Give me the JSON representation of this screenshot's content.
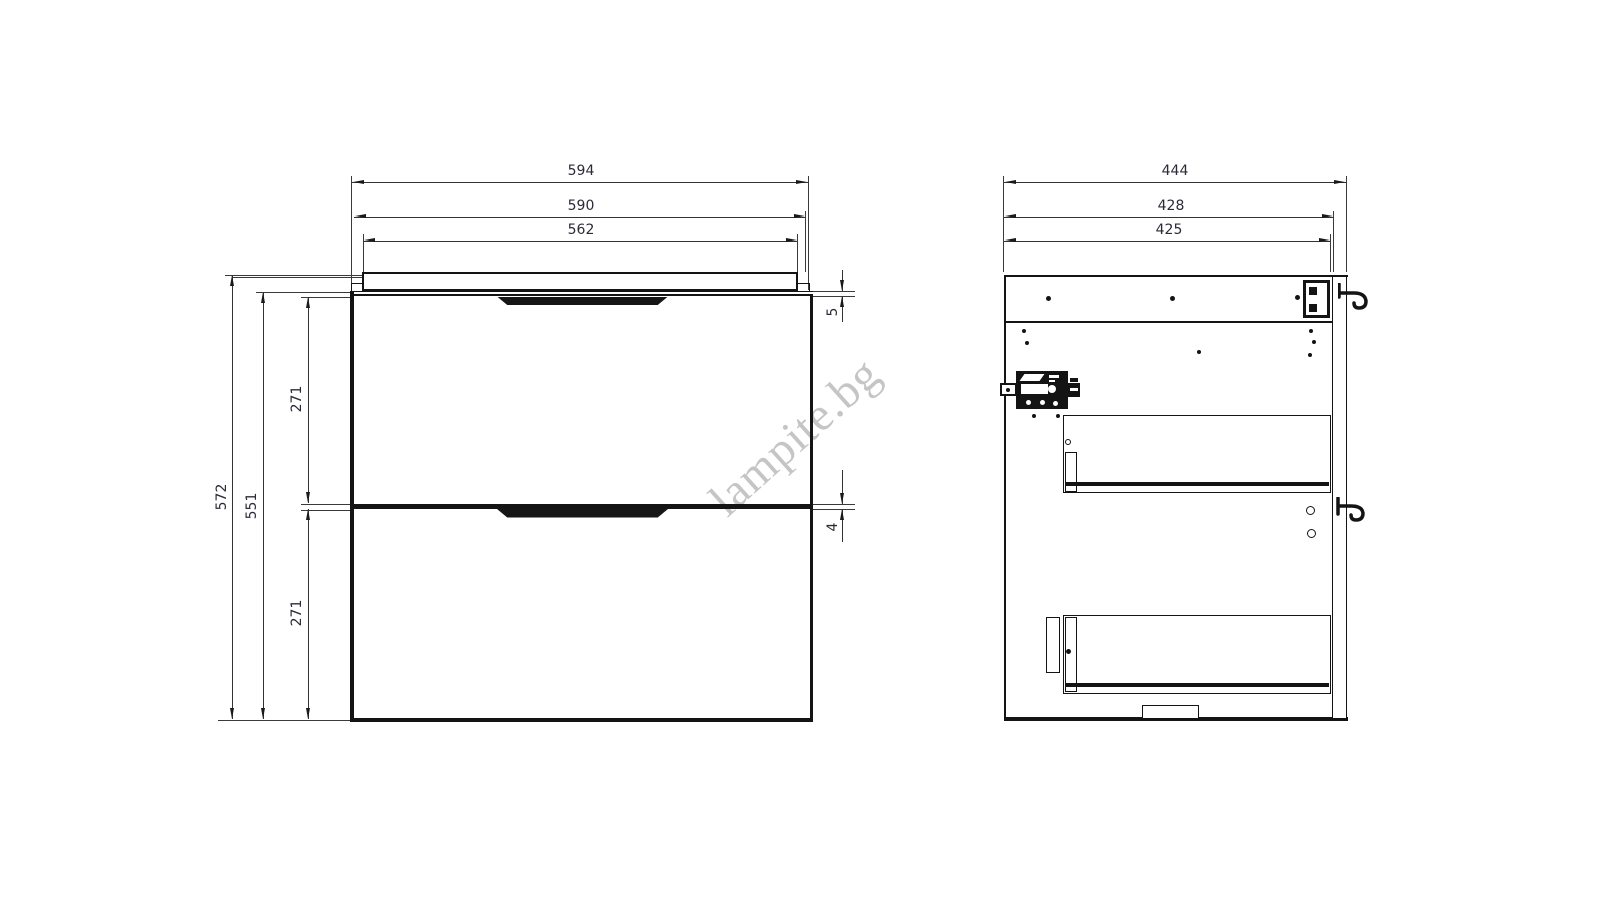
{
  "page": {
    "background": "#ffffff",
    "description": "Technical dimension drawing of a two-drawer wall-hung vanity cabinet: front view and side cross-section view"
  },
  "colors": {
    "line": "#141414",
    "dimension_text": "#2b2b38",
    "watermark": "#c5c5c5"
  },
  "watermark": {
    "text": "lampite.bg"
  },
  "front_view": {
    "width_dims": [
      {
        "id": "overall-width",
        "label": "594"
      },
      {
        "id": "carcass-width",
        "label": "590"
      },
      {
        "id": "drawer-width",
        "label": "562"
      }
    ],
    "height_dims": [
      {
        "id": "overall-height",
        "label": "572"
      },
      {
        "id": "carcass-height",
        "label": "551"
      },
      {
        "id": "top-drawer-height",
        "label": "271"
      },
      {
        "id": "bottom-drawer-height",
        "label": "271"
      }
    ],
    "gap_dims": [
      {
        "id": "countertop-gap",
        "label": "5"
      },
      {
        "id": "drawer-gap",
        "label": "4"
      }
    ]
  },
  "side_view": {
    "depth_dims": [
      {
        "id": "overall-depth",
        "label": "444"
      },
      {
        "id": "carcass-depth",
        "label": "428"
      },
      {
        "id": "inner-depth",
        "label": "425"
      }
    ]
  }
}
